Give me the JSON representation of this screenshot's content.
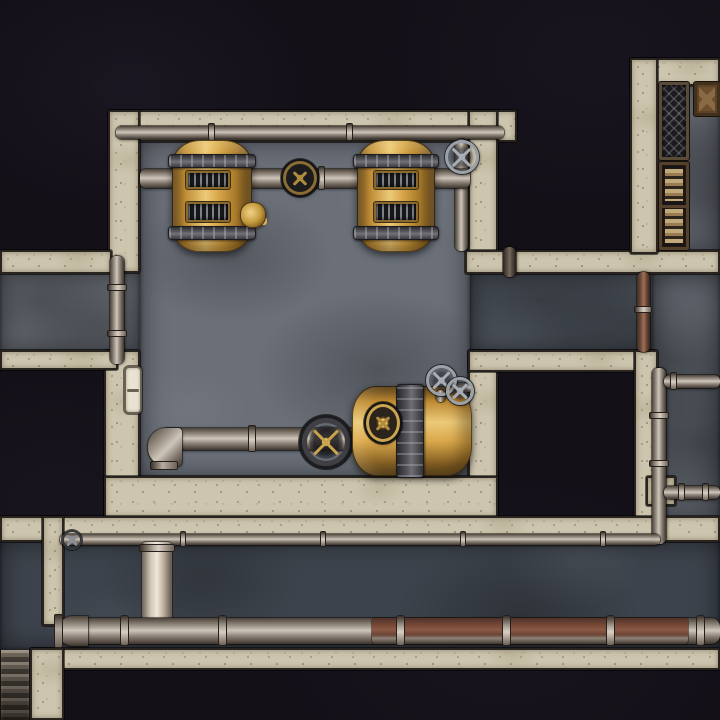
{
  "meta": {
    "title": "steampunk-boiler-room-battle-map",
    "description": "top-down dungeon battle map, no visible text on screen",
    "canvas_size": "720x720",
    "grid_visible": false
  },
  "palette": {
    "background_black": "#131018",
    "wall_stone": "#cdc5ae",
    "wall_edge": "#29241f",
    "floor_room": "#6a6f78",
    "floor_passage": "#484e57",
    "floor_right": "#575c64",
    "floor_armory": "#62676f",
    "floor_corridor": "#3d434c",
    "pipe_gray": "#9c9288",
    "pipe_rust": "#7a5142",
    "brass": "#d9a74a",
    "brass_highlight": "#ecca78",
    "iron_band": "#55555b",
    "valve_silver": "#9aa1a8",
    "valve_gold": "#c9a24a",
    "book_tan": "#c2a97c",
    "crate_brown": "#6d4e2f",
    "door_ivory": "#e9e3d3"
  },
  "elements": [
    {
      "type": "floor",
      "variant": "shade-a",
      "name": "floor-west-corridor",
      "x": 0,
      "y": 272,
      "w": 140,
      "h": 80,
      "interactable": false
    },
    {
      "type": "floor",
      "variant": "shade-a",
      "name": "floor-boiler-room",
      "x": 140,
      "y": 140,
      "w": 330,
      "h": 338,
      "interactable": false
    },
    {
      "type": "floor",
      "variant": "shade-b",
      "name": "floor-east-passage",
      "x": 470,
      "y": 272,
      "w": 250,
      "h": 80,
      "interactable": false
    },
    {
      "type": "floor",
      "variant": "shade-bl",
      "name": "floor-right-column",
      "x": 652,
      "y": 272,
      "w": 68,
      "h": 253,
      "interactable": false
    },
    {
      "type": "floor",
      "variant": "shade-c",
      "name": "floor-armory-room",
      "x": 652,
      "y": 80,
      "w": 68,
      "h": 174,
      "interactable": false
    },
    {
      "type": "floor",
      "variant": "shade-d",
      "name": "floor-bottom-corridor",
      "x": 0,
      "y": 540,
      "w": 720,
      "h": 110,
      "interactable": false
    },
    {
      "type": "wall",
      "name": "wall-boilerroom-top",
      "x": 108,
      "y": 110,
      "w": 409,
      "h": 32,
      "interactable": false
    },
    {
      "type": "wall",
      "name": "wall-boilerroom-west-upper",
      "x": 108,
      "y": 110,
      "w": 32,
      "h": 163,
      "interactable": false
    },
    {
      "type": "wall",
      "name": "wall-boilerroom-west-lower",
      "x": 104,
      "y": 350,
      "w": 36,
      "h": 168,
      "interactable": false
    },
    {
      "type": "wall",
      "name": "wall-west-band-upper",
      "x": 0,
      "y": 250,
      "w": 112,
      "h": 24,
      "interactable": false
    },
    {
      "type": "wall",
      "name": "wall-west-band-lower",
      "x": 0,
      "y": 350,
      "w": 118,
      "h": 20,
      "interactable": false
    },
    {
      "type": "wall",
      "name": "wall-boilerroom-east-upper",
      "x": 468,
      "y": 110,
      "w": 30,
      "h": 163,
      "interactable": false
    },
    {
      "type": "wall",
      "name": "wall-boilerroom-east-lower",
      "x": 468,
      "y": 350,
      "w": 30,
      "h": 168,
      "interactable": false
    },
    {
      "type": "wall",
      "name": "wall-band-middle",
      "x": 465,
      "y": 250,
      "w": 255,
      "h": 24,
      "interactable": false
    },
    {
      "type": "wall",
      "name": "wall-armory-north",
      "x": 630,
      "y": 58,
      "w": 90,
      "h": 28,
      "interactable": false
    },
    {
      "type": "wall",
      "name": "wall-armory-west",
      "x": 630,
      "y": 58,
      "w": 28,
      "h": 196,
      "interactable": false
    },
    {
      "type": "wall",
      "name": "wall-darkroom-top",
      "x": 468,
      "y": 350,
      "w": 188,
      "h": 22,
      "interactable": false
    },
    {
      "type": "wall",
      "name": "wall-darkroom-east",
      "x": 634,
      "y": 350,
      "w": 24,
      "h": 192,
      "interactable": false
    },
    {
      "type": "wall",
      "name": "wall-boilerroom-bottom",
      "x": 104,
      "y": 476,
      "w": 394,
      "h": 42,
      "interactable": false
    },
    {
      "type": "wall",
      "name": "wall-corridor-top",
      "x": 0,
      "y": 516,
      "w": 720,
      "h": 26,
      "interactable": false
    },
    {
      "type": "wall",
      "name": "wall-corridor-bottom",
      "x": 30,
      "y": 648,
      "w": 690,
      "h": 22,
      "interactable": false
    },
    {
      "type": "wall",
      "name": "wall-corridor-spur",
      "x": 42,
      "y": 516,
      "w": 22,
      "h": 110,
      "interactable": false
    },
    {
      "type": "wall",
      "name": "wall-stairs-side",
      "x": 30,
      "y": 648,
      "w": 34,
      "h": 72,
      "interactable": false
    },
    {
      "type": "wall",
      "name": "wall-pipe-support",
      "x": 646,
      "y": 476,
      "w": 30,
      "h": 30,
      "interactable": false
    },
    {
      "type": "stairs",
      "name": "stairs-bottom-left",
      "x": 0,
      "y": 650,
      "w": 30,
      "h": 70,
      "interactable": true
    },
    {
      "type": "door",
      "name": "door-west-wall",
      "x": 124,
      "y": 366,
      "w": 18,
      "h": 48,
      "interactable": true
    },
    {
      "type": "pipe-h",
      "name": "pipe-top-wall",
      "x": 116,
      "y": 126,
      "w": 388,
      "h": 13,
      "interactable": false
    },
    {
      "type": "flange-v",
      "name": "pipe-joint",
      "x": 208,
      "y": 123,
      "w": 7,
      "h": 18,
      "interactable": false
    },
    {
      "type": "flange-v",
      "name": "pipe-joint",
      "x": 346,
      "y": 123,
      "w": 7,
      "h": 18,
      "interactable": false
    },
    {
      "type": "pipe-v",
      "name": "pipe-valve-drop",
      "x": 455,
      "y": 139,
      "w": 13,
      "h": 112,
      "interactable": false
    },
    {
      "type": "pipe-h",
      "name": "pipe-main-boiler",
      "x": 140,
      "y": 169,
      "w": 330,
      "h": 19,
      "interactable": false
    },
    {
      "type": "flange-v",
      "name": "pipe-joint",
      "x": 318,
      "y": 166,
      "w": 7,
      "h": 24,
      "interactable": false
    },
    {
      "type": "pipe-v",
      "name": "pipe-west-riser",
      "x": 110,
      "y": 256,
      "w": 14,
      "h": 108,
      "interactable": false
    },
    {
      "type": "flange-h",
      "name": "pipe-joint",
      "x": 107,
      "y": 284,
      "w": 20,
      "h": 7,
      "interactable": false
    },
    {
      "type": "flange-h",
      "name": "pipe-joint",
      "x": 107,
      "y": 330,
      "w": 20,
      "h": 7,
      "interactable": false
    },
    {
      "type": "pipe-v",
      "variant": "dark",
      "name": "pipe-stub-band",
      "x": 503,
      "y": 247,
      "w": 13,
      "h": 30,
      "interactable": false
    },
    {
      "type": "pipe-v",
      "variant": "rust",
      "name": "pipe-riser-rust",
      "x": 637,
      "y": 272,
      "w": 13,
      "h": 80,
      "interactable": false
    },
    {
      "type": "flange-h",
      "name": "pipe-joint",
      "x": 634,
      "y": 306,
      "w": 18,
      "h": 7,
      "interactable": false
    },
    {
      "type": "pipe-v",
      "name": "pipe-riser-east",
      "x": 652,
      "y": 368,
      "w": 14,
      "h": 176,
      "interactable": false
    },
    {
      "type": "flange-h",
      "name": "pipe-joint",
      "x": 649,
      "y": 412,
      "w": 20,
      "h": 7,
      "interactable": false
    },
    {
      "type": "flange-h",
      "name": "pipe-joint",
      "x": 649,
      "y": 460,
      "w": 20,
      "h": 7,
      "interactable": false
    },
    {
      "type": "pipe-h",
      "name": "pipe-branch-upper",
      "x": 664,
      "y": 375,
      "w": 56,
      "h": 13,
      "interactable": false
    },
    {
      "type": "flange-v",
      "name": "pipe-joint",
      "x": 670,
      "y": 372,
      "w": 7,
      "h": 18,
      "interactable": false
    },
    {
      "type": "pipe-h",
      "name": "pipe-branch-lower",
      "x": 664,
      "y": 486,
      "w": 56,
      "h": 13,
      "interactable": false
    },
    {
      "type": "flange-v",
      "name": "pipe-joint",
      "x": 678,
      "y": 483,
      "w": 7,
      "h": 18,
      "interactable": false
    },
    {
      "type": "flange-v",
      "name": "pipe-joint",
      "x": 702,
      "y": 483,
      "w": 7,
      "h": 18,
      "interactable": false
    },
    {
      "type": "pipe-h",
      "variant": "thin",
      "name": "pipe-corridor-thin",
      "x": 60,
      "y": 534,
      "w": 600,
      "h": 11,
      "interactable": false
    },
    {
      "type": "flange-v",
      "name": "pipe-joint",
      "x": 180,
      "y": 531,
      "w": 6,
      "h": 16,
      "interactable": false
    },
    {
      "type": "flange-v",
      "name": "pipe-joint",
      "x": 320,
      "y": 531,
      "w": 6,
      "h": 16,
      "interactable": false
    },
    {
      "type": "flange-v",
      "name": "pipe-joint",
      "x": 460,
      "y": 531,
      "w": 6,
      "h": 16,
      "interactable": false
    },
    {
      "type": "flange-v",
      "name": "pipe-joint",
      "x": 600,
      "y": 531,
      "w": 6,
      "h": 16,
      "interactable": false
    },
    {
      "type": "valve-wheel",
      "variant": "dark-small",
      "name": "valve-corridor",
      "x": 62,
      "y": 530,
      "w": 20,
      "h": 20,
      "interactable": true
    },
    {
      "type": "duct",
      "name": "duct-vertical",
      "x": 142,
      "y": 542,
      "w": 30,
      "h": 84,
      "interactable": false
    },
    {
      "type": "flange-h",
      "name": "pipe-joint",
      "x": 139,
      "y": 544,
      "w": 36,
      "h": 8,
      "interactable": false
    },
    {
      "type": "pipe-h",
      "variant": "thick",
      "name": "pipe-corridor-main",
      "x": 64,
      "y": 618,
      "w": 656,
      "h": 26,
      "interactable": false
    },
    {
      "type": "pipe-rust-overlay",
      "name": "pipe-rust-section",
      "x": 372,
      "y": 618,
      "w": 316,
      "h": 26,
      "interactable": false
    },
    {
      "type": "elbow-cap",
      "name": "pipe-end-cap",
      "x": 58,
      "y": 616,
      "w": 30,
      "h": 30,
      "interactable": false
    },
    {
      "type": "flange-v",
      "variant": "big",
      "name": "pipe-joint",
      "x": 120,
      "y": 615,
      "w": 9,
      "h": 31,
      "interactable": false
    },
    {
      "type": "flange-v",
      "variant": "big",
      "name": "pipe-joint",
      "x": 218,
      "y": 615,
      "w": 9,
      "h": 31,
      "interactable": false
    },
    {
      "type": "flange-v",
      "variant": "big",
      "name": "pipe-joint",
      "x": 396,
      "y": 615,
      "w": 9,
      "h": 31,
      "interactable": false
    },
    {
      "type": "flange-v",
      "variant": "big",
      "name": "pipe-joint",
      "x": 502,
      "y": 615,
      "w": 9,
      "h": 31,
      "interactable": false
    },
    {
      "type": "flange-v",
      "variant": "big",
      "name": "pipe-joint",
      "x": 606,
      "y": 615,
      "w": 9,
      "h": 31,
      "interactable": false
    },
    {
      "type": "flange-v",
      "variant": "big",
      "name": "pipe-joint",
      "x": 696,
      "y": 615,
      "w": 9,
      "h": 31,
      "interactable": false
    },
    {
      "type": "pipe-h",
      "name": "pipe-lower-west",
      "x": 162,
      "y": 428,
      "w": 196,
      "h": 22,
      "interactable": false
    },
    {
      "type": "flange-v",
      "name": "pipe-joint",
      "x": 248,
      "y": 425,
      "w": 8,
      "h": 27,
      "interactable": false
    },
    {
      "type": "elbow-sw",
      "name": "pipe-elbow-west",
      "x": 148,
      "y": 428,
      "w": 34,
      "h": 38,
      "interactable": false
    },
    {
      "type": "gauge",
      "name": "pressure-gauge",
      "x": 283,
      "y": 161,
      "w": 34,
      "h": 34,
      "interactable": true
    },
    {
      "type": "valve-wheel",
      "variant": "silver",
      "name": "valve-wheel-north",
      "x": 445,
      "y": 140,
      "w": 34,
      "h": 34,
      "interactable": true
    },
    {
      "type": "boiler-v",
      "name": "boiler-left",
      "x": 172,
      "y": 140,
      "w": 80,
      "h": 112,
      "interactable": true
    },
    {
      "type": "boiler-band",
      "name": "boiler-band",
      "x": 168,
      "y": 154,
      "w": 88,
      "h": 14,
      "interactable": false
    },
    {
      "type": "boiler-band",
      "name": "boiler-band",
      "x": 168,
      "y": 226,
      "w": 88,
      "h": 14,
      "interactable": false
    },
    {
      "type": "grate",
      "name": "boiler-vent",
      "x": 186,
      "y": 171,
      "w": 44,
      "h": 18,
      "interactable": false
    },
    {
      "type": "grate",
      "name": "boiler-vent",
      "x": 186,
      "y": 202,
      "w": 44,
      "h": 20,
      "interactable": false
    },
    {
      "type": "brass-fitting",
      "name": "brass-spigot",
      "x": 240,
      "y": 202,
      "w": 26,
      "h": 26,
      "interactable": true
    },
    {
      "type": "boiler-v",
      "name": "boiler-right",
      "x": 357,
      "y": 140,
      "w": 78,
      "h": 112,
      "interactable": true
    },
    {
      "type": "boiler-band",
      "name": "boiler-band",
      "x": 353,
      "y": 154,
      "w": 86,
      "h": 14,
      "interactable": false
    },
    {
      "type": "boiler-band",
      "name": "boiler-band",
      "x": 353,
      "y": 226,
      "w": 86,
      "h": 14,
      "interactable": false
    },
    {
      "type": "grate",
      "name": "boiler-vent",
      "x": 374,
      "y": 171,
      "w": 44,
      "h": 18,
      "interactable": false
    },
    {
      "type": "grate",
      "name": "boiler-vent",
      "x": 374,
      "y": 202,
      "w": 44,
      "h": 20,
      "interactable": false
    },
    {
      "type": "valve-wheel",
      "variant": "iron-gold",
      "name": "valve-wheel-main",
      "x": 302,
      "y": 418,
      "w": 48,
      "h": 48,
      "interactable": true
    },
    {
      "type": "boiler-h",
      "name": "boiler-horizontal",
      "x": 352,
      "y": 386,
      "w": 120,
      "h": 90,
      "interactable": true
    },
    {
      "type": "boiler-band-v",
      "name": "boiler-band",
      "x": 396,
      "y": 384,
      "w": 28,
      "h": 94,
      "interactable": false
    },
    {
      "type": "gauge",
      "variant": "brass",
      "name": "boiler-gauge",
      "x": 366,
      "y": 404,
      "w": 34,
      "h": 38,
      "interactable": false
    },
    {
      "type": "pipe-h",
      "variant": "thin",
      "name": "pipe-stub",
      "x": 455,
      "y": 383,
      "w": 18,
      "h": 9,
      "interactable": false
    },
    {
      "type": "pipe-v",
      "variant": "thin",
      "name": "pipe-stub",
      "x": 436,
      "y": 390,
      "w": 9,
      "h": 12,
      "interactable": false
    },
    {
      "type": "valve-wheel",
      "variant": "silver",
      "name": "valve-wheel-small-a",
      "x": 426,
      "y": 365,
      "w": 31,
      "h": 31,
      "interactable": true
    },
    {
      "type": "valve-wheel",
      "variant": "silver",
      "name": "valve-wheel-small-b",
      "x": 446,
      "y": 377,
      "w": 28,
      "h": 28,
      "interactable": true
    },
    {
      "type": "rack",
      "name": "storage-rack",
      "x": 659,
      "y": 82,
      "w": 30,
      "h": 78,
      "interactable": true
    },
    {
      "type": "crate",
      "name": "wooden-crate",
      "x": 694,
      "y": 82,
      "w": 26,
      "h": 34,
      "interactable": true
    },
    {
      "type": "bookshelf",
      "name": "bookshelf",
      "x": 659,
      "y": 162,
      "w": 30,
      "h": 88,
      "interactable": true
    },
    {
      "type": "books",
      "name": "book-stack",
      "x": 664,
      "y": 168,
      "w": 20,
      "h": 34,
      "interactable": false
    },
    {
      "type": "books",
      "name": "book-stack",
      "x": 664,
      "y": 208,
      "w": 20,
      "h": 36,
      "interactable": false
    }
  ]
}
